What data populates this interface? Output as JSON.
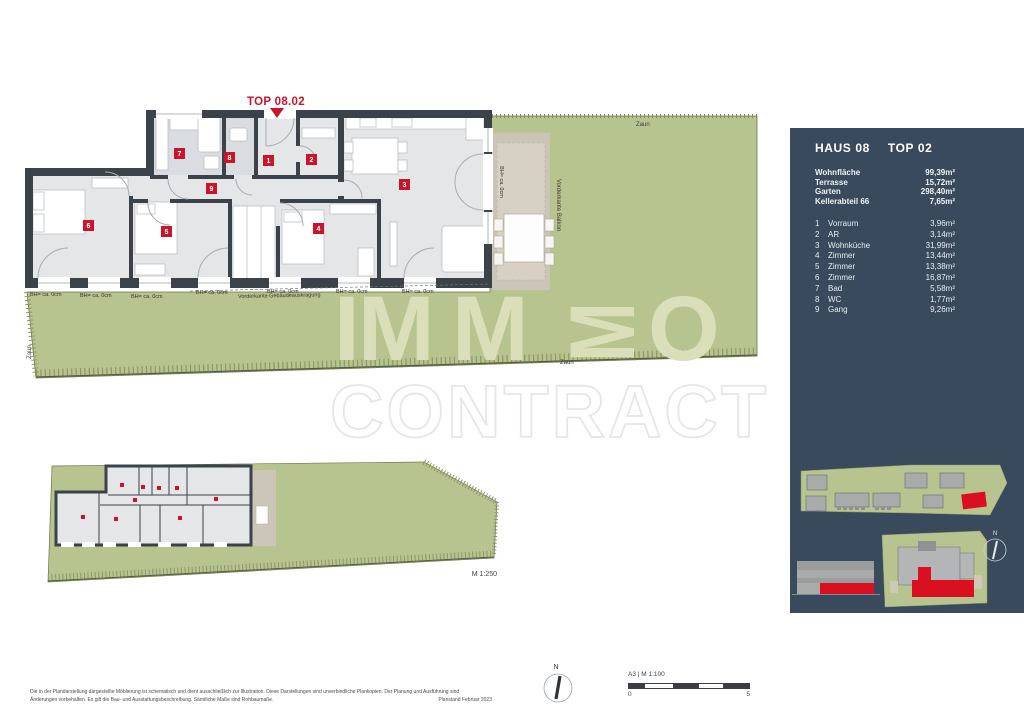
{
  "plan": {
    "unit_label": "TOP 08.02",
    "badges": [
      {
        "num": "1"
      },
      {
        "num": "2"
      },
      {
        "num": "3"
      },
      {
        "num": "4"
      },
      {
        "num": "5"
      },
      {
        "num": "6"
      },
      {
        "num": "7"
      },
      {
        "num": "8"
      },
      {
        "num": "9"
      }
    ],
    "labels": {
      "zaun": "Zaun",
      "bh": "BH= ca. 0cm",
      "vorderkante_balkon": "Vorderkante Balkon",
      "vorderkante_gebaeude": "Vorderkante Gebäudeauskragung"
    }
  },
  "mini_plan": {
    "scale": "M 1:250"
  },
  "watermark": {
    "letters": [
      "I",
      "M",
      "M",
      "M",
      "O"
    ],
    "line2": "CONTRACT"
  },
  "sidebar": {
    "title_left": "HAUS 08",
    "title_right": "TOP 02",
    "summary": [
      {
        "label": "Wohnfläche",
        "value": "99,39m²"
      },
      {
        "label": "Terrasse",
        "value": "15,72m²"
      },
      {
        "label": "Garten",
        "value": "298,40m²"
      },
      {
        "label": "Kellerabteil 66",
        "value": "7,65m²"
      }
    ],
    "rooms": [
      {
        "num": "1",
        "label": "Vorraum",
        "value": "3,96m²"
      },
      {
        "num": "2",
        "label": "AR",
        "value": "3,14m²"
      },
      {
        "num": "3",
        "label": "Wohnküche",
        "value": "31,99m²"
      },
      {
        "num": "4",
        "label": "Zimmer",
        "value": "13,44m²"
      },
      {
        "num": "5",
        "label": "Zimmer",
        "value": "13,38m²"
      },
      {
        "num": "6",
        "label": "Zimmer",
        "value": "16,87m²"
      },
      {
        "num": "7",
        "label": "Bad",
        "value": "5,58m²"
      },
      {
        "num": "8",
        "label": "WC",
        "value": "1,77m²"
      },
      {
        "num": "9",
        "label": "Gang",
        "value": "9,26m²"
      }
    ],
    "compass_n": "N"
  },
  "footer": {
    "disclaimer1": "Die in der Plandarstellung dargestellte Möblierung ist schematisch und dient ausschließlich zur Illustration. Diese Darstellungen sind unverbindliche Plankopien. Der Planung und Ausführung sind",
    "disclaimer2": "Änderungen vorbehalten. Es gilt die Bau- und Ausstattungsbeschreibung. Sämtliche Maße sind Rohbaumaße.",
    "plan_date": "Planstand Februar 2023",
    "north": "N",
    "format_scale": "A3 | M 1:100",
    "scale_zero": "0",
    "scale_five": "5"
  },
  "colors": {
    "accent_red": "#C8142B",
    "panel_dark": "#384A5C",
    "garden_green": "#B8C48F",
    "terrace_beige": "#CBC5B8",
    "wall_dark": "#3B4249",
    "floor_gray": "#E4E6E7"
  }
}
